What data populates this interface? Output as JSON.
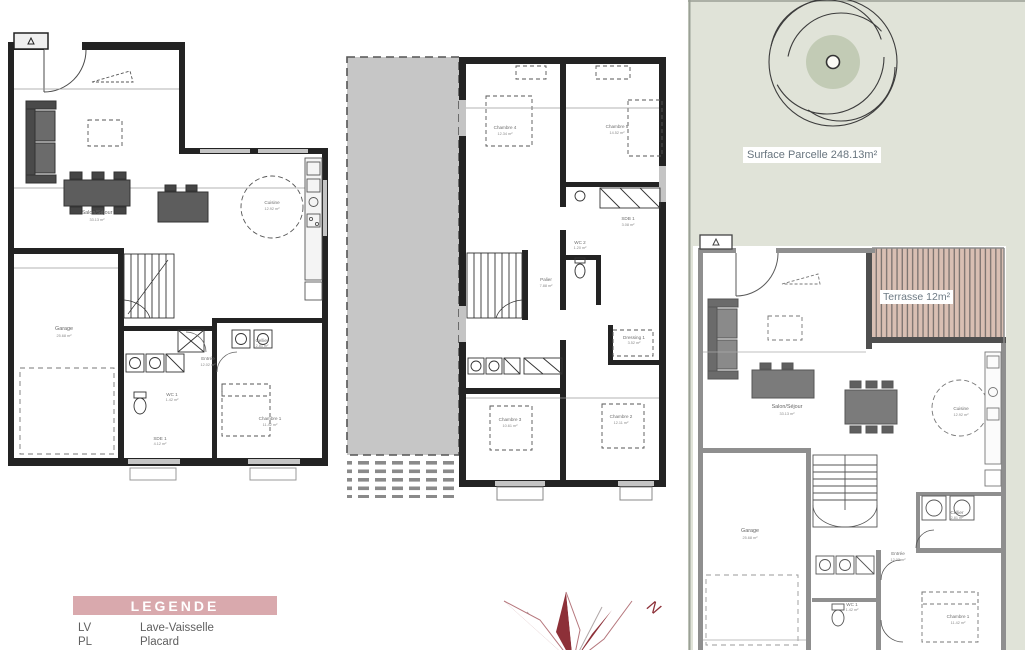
{
  "parcel": {
    "surface_label": "Surface Parcelle 248.13m²",
    "terrace_label": "Terrasse 12m²"
  },
  "legend": {
    "title": "LEGENDE",
    "items": [
      {
        "abbr": "LV",
        "label": "Lave-Vaisselle"
      },
      {
        "abbr": "PL",
        "label": "Placard"
      }
    ]
  },
  "compass": {
    "north": "N"
  },
  "plans": {
    "left": {
      "rooms": [
        {
          "label": "Salon/Séjour",
          "area": "33.13 m²"
        },
        {
          "label": "Cuisine",
          "area": "12.92 m²"
        },
        {
          "label": "Garage",
          "area": "25.68 m²"
        },
        {
          "label": "Entrée",
          "area": "12.02 m²"
        },
        {
          "label": "WC 1",
          "area": "1.42 m²"
        },
        {
          "label": "SDE 1",
          "area": "4.12 m²"
        },
        {
          "label": "Chambre 1",
          "area": "11.42 m²"
        },
        {
          "label": "Cellier",
          "area": "2.81 m²"
        }
      ]
    },
    "middle": {
      "rooms": [
        {
          "label": "Chambre 4",
          "area": "12.34 m²"
        },
        {
          "label": "Chambre 5",
          "area": "14.52 m²"
        },
        {
          "label": "SDB 1",
          "area": "3.08 m²"
        },
        {
          "label": "WC 2",
          "area": "1.20 m²"
        },
        {
          "label": "Palier",
          "area": "7.88 m²"
        },
        {
          "label": "Dressing 1",
          "area": "3.52 m²"
        },
        {
          "label": "Chambre 3",
          "area": "10.61 m²"
        },
        {
          "label": "Chambre 2",
          "area": "12.11 m²"
        }
      ]
    },
    "right": {
      "rooms": [
        {
          "label": "Salon/Séjour",
          "area": "33.13 m²"
        },
        {
          "label": "Cuisine",
          "area": "12.92 m²"
        },
        {
          "label": "Garage",
          "area": "25.68 m²"
        },
        {
          "label": "Entrée",
          "area": "12.02 m²"
        },
        {
          "label": "Cellier",
          "area": "2.81 m²"
        },
        {
          "label": "Chambre 1",
          "area": "11.42 m²"
        },
        {
          "label": "WC 1",
          "area": "1.42 m²"
        }
      ]
    }
  },
  "colors": {
    "parcel_green": "#e0e3d8",
    "tree_green": "#c2cbb5",
    "terrace_wood": "#d9bfb3",
    "legend_pink": "#d9a9ad",
    "compass_red": "#8d3038",
    "wall_dark": "#232323",
    "wall_gray": "#8f8f8f"
  }
}
